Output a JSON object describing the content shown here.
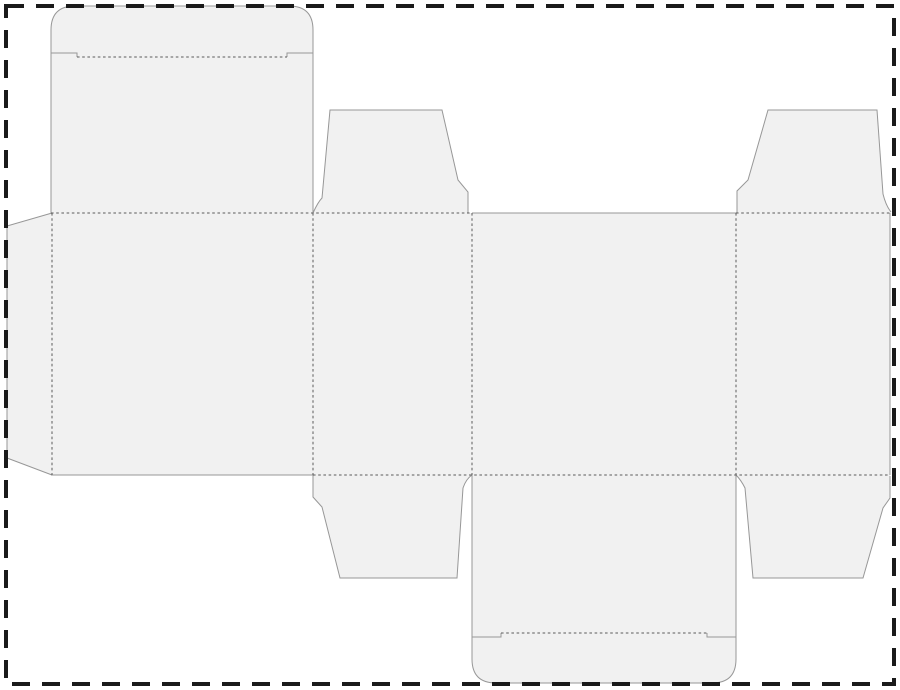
{
  "page": {
    "title": "box-dieline-template",
    "width": 900,
    "height": 690,
    "background": "#ffffff",
    "border": {
      "name": "page-dashed-border",
      "color": "#1a1a1a",
      "thickness": 4,
      "dash": "18 12",
      "x": 6,
      "y": 6,
      "w": 888,
      "h": 678
    }
  },
  "dieline": {
    "name": "straight-tuck-end-box-dieline",
    "fill": "#f1f1f1",
    "cut_color": "#979797",
    "cut_width": 1,
    "fold_color": "#5a5a5a",
    "fold_width": 1,
    "fold_dash": "2.6 2.6",
    "pieces": [
      {
        "name": "glue-flap",
        "d": "M 52 213 L 7 226 L 7 458 L 52 475 Z"
      },
      {
        "name": "back-panel-top-lid-and-tuck",
        "d": "M 51 475 L 51 30 Q 51 6 75 6 L 289 6 Q 313 6 313 30 L 313 475 Z"
      },
      {
        "name": "side-panel-left",
        "d": "M 313 213 L 472 213 L 472 475 L 313 475 Z"
      },
      {
        "name": "top-dust-flap-left",
        "d": "M 313 213 Q 318 202 322 198 L 330 110 L 442 110 L 458 180 L 468 192 L 468 213 Z"
      },
      {
        "name": "bottom-dust-flap-left",
        "d": "M 313 475 L 313 497 L 322 507 L 340 578 L 457 578 L 463 488 Q 466 479 472 475 Z"
      },
      {
        "name": "front-panel",
        "d": "M 472 213 L 736 213 L 736 475 L 472 475 Z"
      },
      {
        "name": "bottom-lid-and-tuck",
        "d": "M 472 475 L 736 475 L 736 659 Q 736 683 712 683 L 496 683 Q 472 683 472 659 Z"
      },
      {
        "name": "side-panel-right",
        "d": "M 736 213 L 890 213 L 890 475 L 736 475 Z"
      },
      {
        "name": "top-dust-flap-right",
        "d": "M 737 213 L 737 191 L 748 180 L 768 110 L 877 110 L 883 194 Q 886 206 891 213 Z"
      },
      {
        "name": "bottom-dust-flap-right",
        "d": "M 736 475 Q 741 480 745 488 L 753 578 L 863 578 L 883 508 L 890 498 L 890 475 Z"
      }
    ],
    "cut_lines": [
      {
        "name": "glue-flap-cut",
        "d": "M 52 213 L 7 226 L 7 458 L 52 475"
      },
      {
        "name": "back-panel-outline-cut",
        "d": "M 51 213 L 51 30 Q 51 6 75 6 L 289 6 Q 313 6 313 30 L 313 213"
      },
      {
        "name": "top-tuck-shoulder-left-cut",
        "d": "M 51 53 L 77 53 L 77 57"
      },
      {
        "name": "top-tuck-shoulder-right-cut",
        "d": "M 313 53 L 287 53 L 287 57"
      },
      {
        "name": "back-panel-bottom-cut",
        "d": "M 51 475 L 313 475"
      },
      {
        "name": "top-dust-flap-left-cut",
        "d": "M 313 213 Q 318 202 322 198 L 330 110 L 442 110 L 458 180 L 468 192 L 468 213"
      },
      {
        "name": "bottom-dust-flap-left-cut",
        "d": "M 313 475 L 313 497 L 322 507 L 340 578 L 457 578 L 463 488 Q 466 479 472 475"
      },
      {
        "name": "front-panel-top-cut",
        "d": "M 472 213 L 736 213"
      },
      {
        "name": "bottom-lid-outline-cut",
        "d": "M 472 475 L 472 659 Q 472 683 496 683 L 712 683 Q 736 683 736 659 L 736 475"
      },
      {
        "name": "bottom-tuck-shoulder-left-cut",
        "d": "M 472 637 L 501 637 L 501 633"
      },
      {
        "name": "bottom-tuck-shoulder-right-cut",
        "d": "M 736 637 L 707 637 L 707 633"
      },
      {
        "name": "top-dust-flap-right-cut",
        "d": "M 737 213 L 737 191 L 748 180 L 768 110 L 877 110 L 883 194 Q 886 206 891 212"
      },
      {
        "name": "bottom-dust-flap-right-cut",
        "d": "M 736 475 Q 741 480 745 488 L 753 578 L 863 578 L 883 508 L 890 498 L 890 476"
      },
      {
        "name": "side-panel-right-outer-cut",
        "d": "M 890 213 L 890 475"
      }
    ],
    "fold_lines": [
      {
        "name": "glue-flap-fold",
        "d": "M 52 213 L 52 475"
      },
      {
        "name": "top-tuck-fold",
        "d": "M 77 57 L 287 57"
      },
      {
        "name": "top-main-fold-left",
        "d": "M 51 213 L 472 213"
      },
      {
        "name": "top-main-fold-right",
        "d": "M 736 213 L 890 213"
      },
      {
        "name": "bottom-main-fold",
        "d": "M 313 475 L 890 475"
      },
      {
        "name": "panel-fold-1",
        "d": "M 313 213 L 313 475"
      },
      {
        "name": "panel-fold-2",
        "d": "M 472 213 L 472 475"
      },
      {
        "name": "panel-fold-3",
        "d": "M 736 213 L 736 475"
      },
      {
        "name": "bottom-tuck-fold",
        "d": "M 501 633 L 707 633"
      }
    ]
  }
}
